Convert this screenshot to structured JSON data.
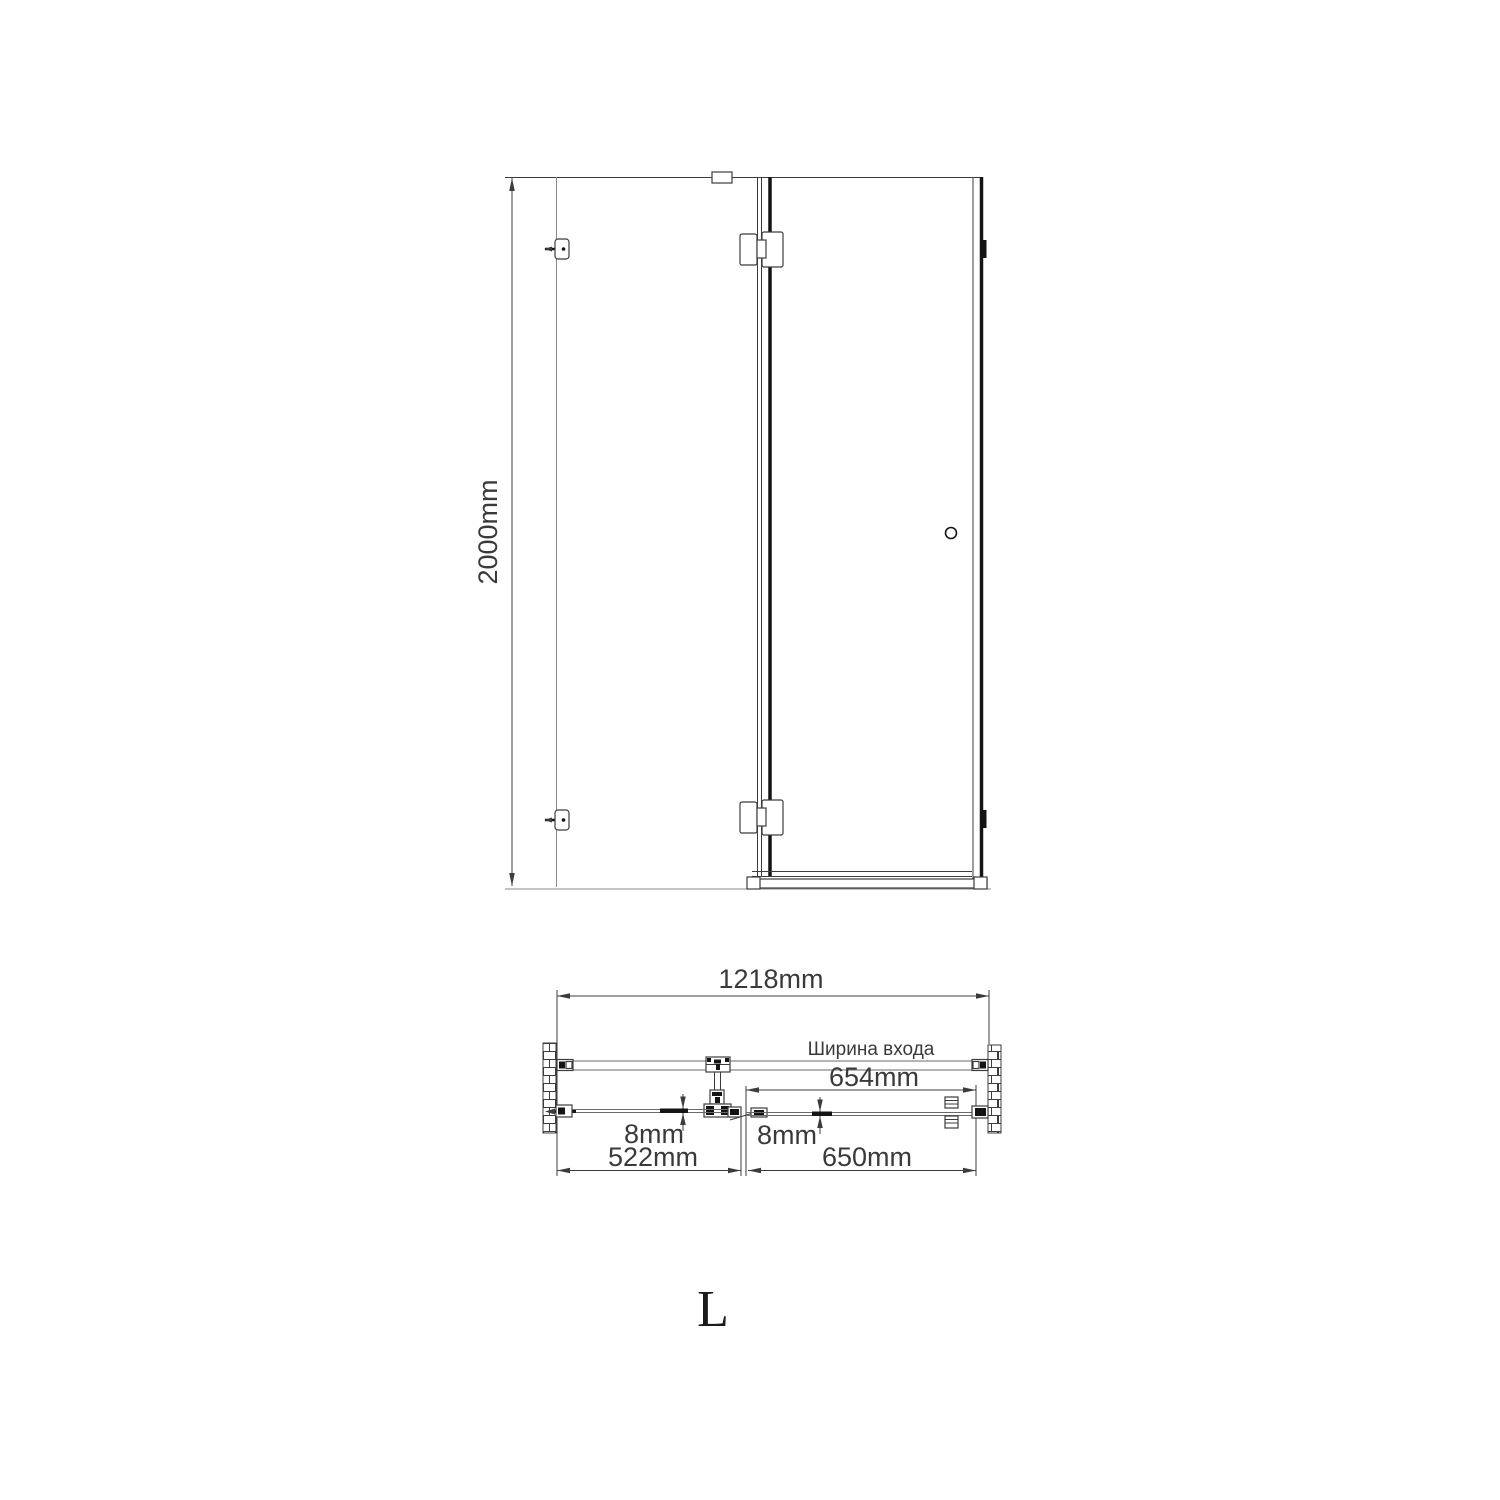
{
  "drawing": {
    "front_view": {
      "height_label": "2000mm"
    },
    "plan_view": {
      "total_width_label": "1218mm",
      "entrance_title": "Ширина входа",
      "entrance_width_label": "654mm",
      "fixed_panel_width_label": "522mm",
      "door_width_label": "650mm",
      "glass_thickness_left_label": "8mm",
      "glass_thickness_right_label": "8mm"
    },
    "orientation_label": "L",
    "colors": {
      "line": "#3c3c3c",
      "thick_line": "#141414",
      "light_line": "#8a8a8a",
      "background": "#ffffff"
    }
  }
}
